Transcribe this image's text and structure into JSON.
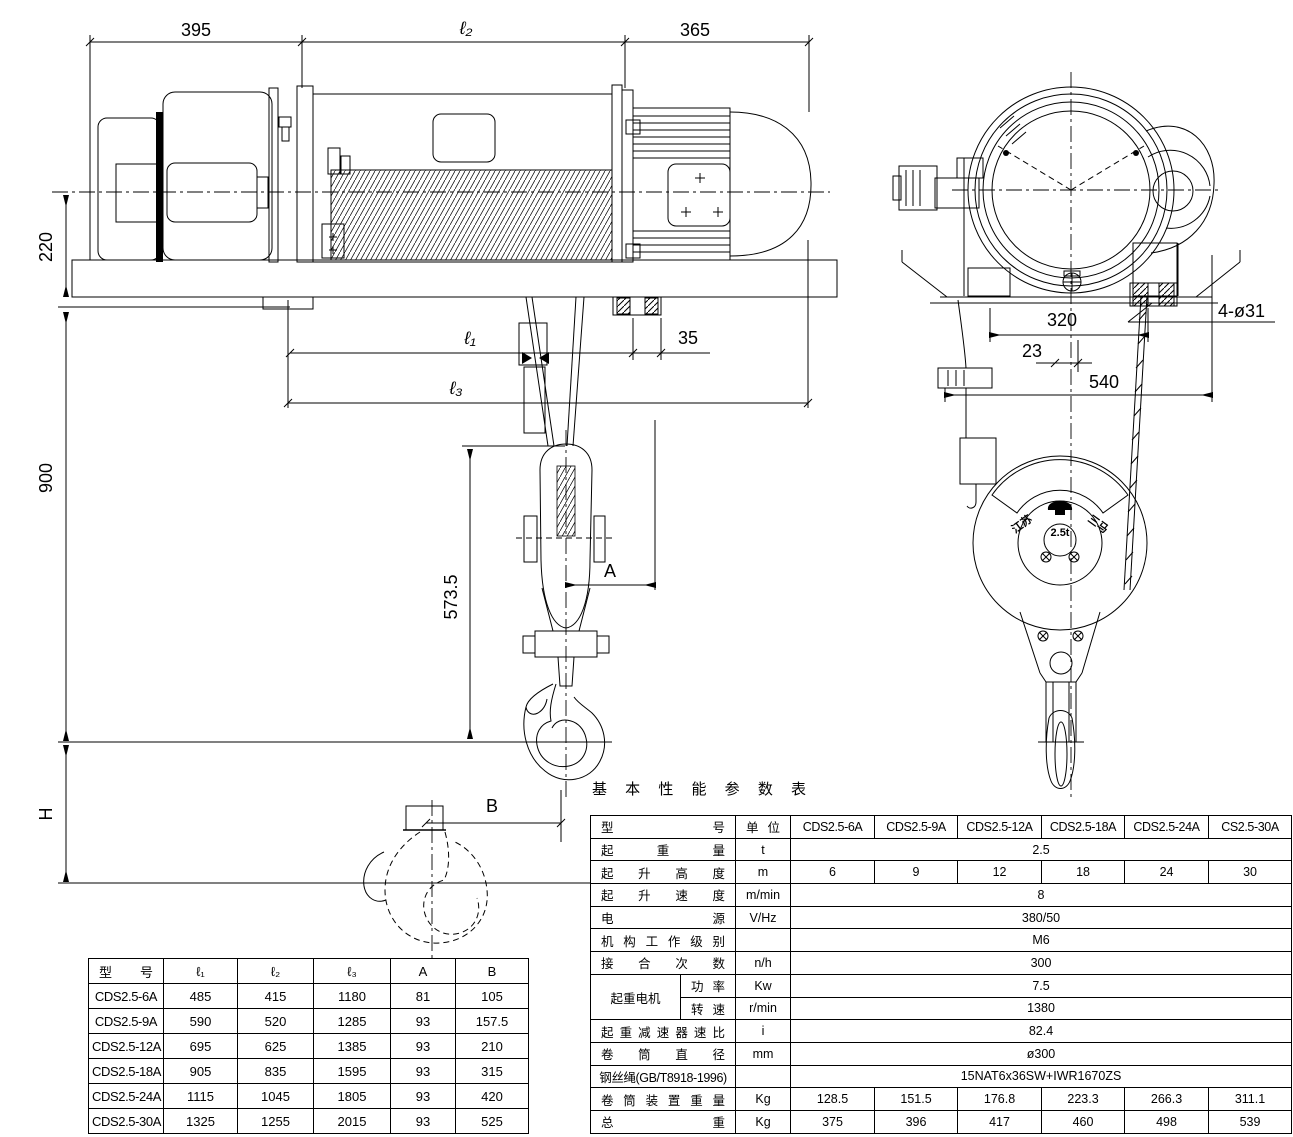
{
  "drawing": {
    "dims": {
      "top_left": "395",
      "top_mid": "ℓ₂",
      "top_right": "365",
      "left_220": "220",
      "left_900": "900",
      "left_h": "H",
      "l1": "ℓ₁",
      "d35": "35",
      "l3": "ℓ₃",
      "v5735": "573.5",
      "a": "A",
      "b": "B",
      "ev_320": "320",
      "ev_23": "23",
      "ev_540": "540",
      "ev_holes": "4-ø31"
    },
    "logo": {
      "left": "江苏",
      "center": "2.5t",
      "right": "三马"
    },
    "plus1": "+",
    "plus2": "+"
  },
  "dim_table": {
    "headers": [
      "型 号",
      "ℓ₁",
      "ℓ₂",
      "ℓ₃",
      "A",
      "B"
    ],
    "rows": [
      [
        "CDS2.5-6A",
        "485",
        "415",
        "1180",
        "81",
        "105"
      ],
      [
        "CDS2.5-9A",
        "590",
        "520",
        "1285",
        "93",
        "157.5"
      ],
      [
        "CDS2.5-12A",
        "695",
        "625",
        "1385",
        "93",
        "210"
      ],
      [
        "CDS2.5-18A",
        "905",
        "835",
        "1595",
        "93",
        "315"
      ],
      [
        "CDS2.5-24A",
        "1115",
        "1045",
        "1805",
        "93",
        "420"
      ],
      [
        "CDS2.5-30A",
        "1325",
        "1255",
        "2015",
        "93",
        "525"
      ]
    ]
  },
  "spec_table": {
    "title": "基 本 性 能 参 数 表",
    "header": {
      "label": "型 号",
      "unit": "单 位",
      "models": [
        "CDS2.5-6A",
        "CDS2.5-9A",
        "CDS2.5-12A",
        "CDS2.5-18A",
        "CDS2.5-24A",
        "CS2.5-30A"
      ]
    },
    "capacity": {
      "label": "起 重 量",
      "unit": "t",
      "value": "2.5"
    },
    "lift_height": {
      "label": "起 升 高 度",
      "unit": "m",
      "values": [
        "6",
        "9",
        "12",
        "18",
        "24",
        "30"
      ]
    },
    "lift_speed": {
      "label": "起 升 速 度",
      "unit": "m/min",
      "value": "8"
    },
    "power_supply": {
      "label": "电 源",
      "unit": "V/Hz",
      "value": "380/50"
    },
    "duty_class": {
      "label": "机 构 工 作 级 别",
      "unit": "",
      "value": "M6"
    },
    "starts_per_hour": {
      "label": "接 合 次 数",
      "unit": "n/h",
      "value": "300"
    },
    "motor": {
      "label": "起重电机",
      "power": {
        "label": "功 率",
        "unit": "Kw",
        "value": "7.5"
      },
      "speed": {
        "label": "转 速",
        "unit": "r/min",
        "value": "1380"
      }
    },
    "reducer_ratio": {
      "label": "起 重 减 速 器 速 比",
      "unit": "i",
      "value": "82.4"
    },
    "drum_diameter": {
      "label": "卷 筒 直 径",
      "unit": "mm",
      "value": "ø300"
    },
    "wire_rope": {
      "label": "钢丝绳(GB/T8918-1996)",
      "unit": "",
      "value": "15NAT6x36SW+IWR1670ZS"
    },
    "drum_unit_weight": {
      "label": "卷 筒 装 置 重 量",
      "unit": "Kg",
      "values": [
        "128.5",
        "151.5",
        "176.8",
        "223.3",
        "266.3",
        "311.1"
      ]
    },
    "total_weight": {
      "label": "总 重",
      "unit": "Kg",
      "values": [
        "375",
        "396",
        "417",
        "460",
        "498",
        "539"
      ]
    }
  }
}
